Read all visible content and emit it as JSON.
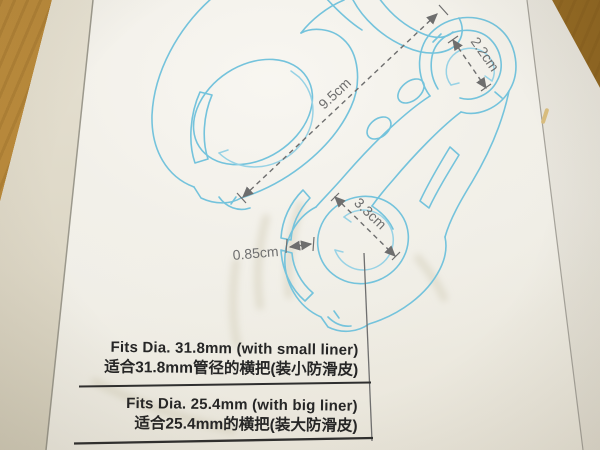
{
  "photo": {
    "description": "instruction card for a handlebar clamp mount photographed on a wooden table",
    "colors": {
      "wood_table": "#a87a2c",
      "paper": "#f2f0e9",
      "card_edge": "#ddd7c6",
      "line_art_cyan": "#74c3dc",
      "dimension_ink": "#6f6f6f",
      "text_ink": "#262626"
    }
  },
  "diagram": {
    "labels": {
      "overall_length": "9.5cm",
      "small_ring_diameter": "2.2cm",
      "clamp_bore_diameter": "3.3cm",
      "band_width": "0.85cm"
    }
  },
  "spec_table": {
    "rows": [
      {
        "en": "Fits Dia. 31.8mm (with small liner)",
        "zh": "适合31.8mm管径的横把(装小防滑皮)"
      },
      {
        "en": "Fits Dia. 25.4mm (with big liner)",
        "zh": "适合25.4mm的横把(装大防滑皮)"
      }
    ]
  }
}
